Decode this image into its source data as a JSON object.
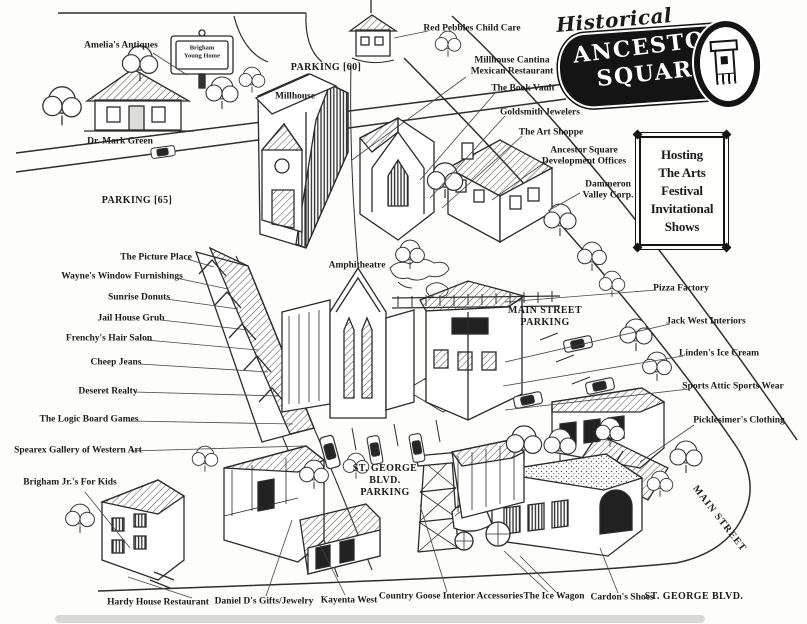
{
  "logo": {
    "historical": "Historical",
    "name_line1": "ANCESTOR",
    "name_line2": "SQUARE",
    "icon": "clock-tower-icon"
  },
  "notice": {
    "lines": [
      "Hosting",
      "The Arts",
      "Festival",
      "Invitational",
      "Shows"
    ]
  },
  "sign_brigham": {
    "line1": "Brigham",
    "line2": "Young Home"
  },
  "streets": {
    "main_street": "MAIN STREET",
    "st_george_blvd": "ST. GEORGE BLVD."
  },
  "parking": {
    "p60": "PARKING [60]",
    "p65": "PARKING [65]",
    "main_street": [
      "MAIN STREET",
      "PARKING"
    ],
    "st_george": [
      "ST. GEORGE",
      "BLVD.",
      "PARKING"
    ]
  },
  "places": {
    "amelias_antiques": "Amelia's Antiques",
    "dr_mark_green": "Dr. Mark Green",
    "red_pebbles": "Red Pebbles Child Care",
    "millhouse": "Millhouse",
    "millhouse_cantina": [
      "Millhouse Cantina",
      "Mexican Restaurant"
    ],
    "book_vault": "The Book Vault",
    "goldsmith": "Goldsmith Jewelers",
    "art_shoppe": "The Art Shoppe",
    "dev_offices": [
      "Ancestor Square",
      "Development Offices"
    ],
    "dammeron": [
      "Dammeron",
      "Valley Corp."
    ],
    "picture_place": "The Picture Place",
    "waynes": "Wayne's Window Furnishings",
    "sunrise": "Sunrise Donuts",
    "jail_house": "Jail House Grub",
    "frenchys": "Frenchy's Hair Salon",
    "cheep_jeans": "Cheep Jeans",
    "deseret": "Deseret Realty",
    "logic_board": "The Logic Board Games",
    "spearex": "Spearex Gallery of Western Art",
    "brigham_jrs": "Brigham Jr.'s For Kids",
    "amphitheatre": "Amphitheatre",
    "pizza_factory": "Pizza Factory",
    "jack_west": "Jack West Interiors",
    "lindens": "Linden's Ice Cream",
    "sports_attic": "Sports Attic Sports Wear",
    "picklesimers": "Picklesimer's Clothing",
    "hardy_house": "Hardy House Restaurant",
    "daniel_ds": "Daniel D's Gifts/Jewelry",
    "kayenta": "Kayenta West",
    "country_goose": "Country Goose Interior Accessories",
    "ice_wagon": "The Ice Wagon",
    "cardons": "Cardon's Shoes"
  },
  "colors": {
    "ink": "#1a1a1a",
    "paper": "#fdfdfb"
  }
}
